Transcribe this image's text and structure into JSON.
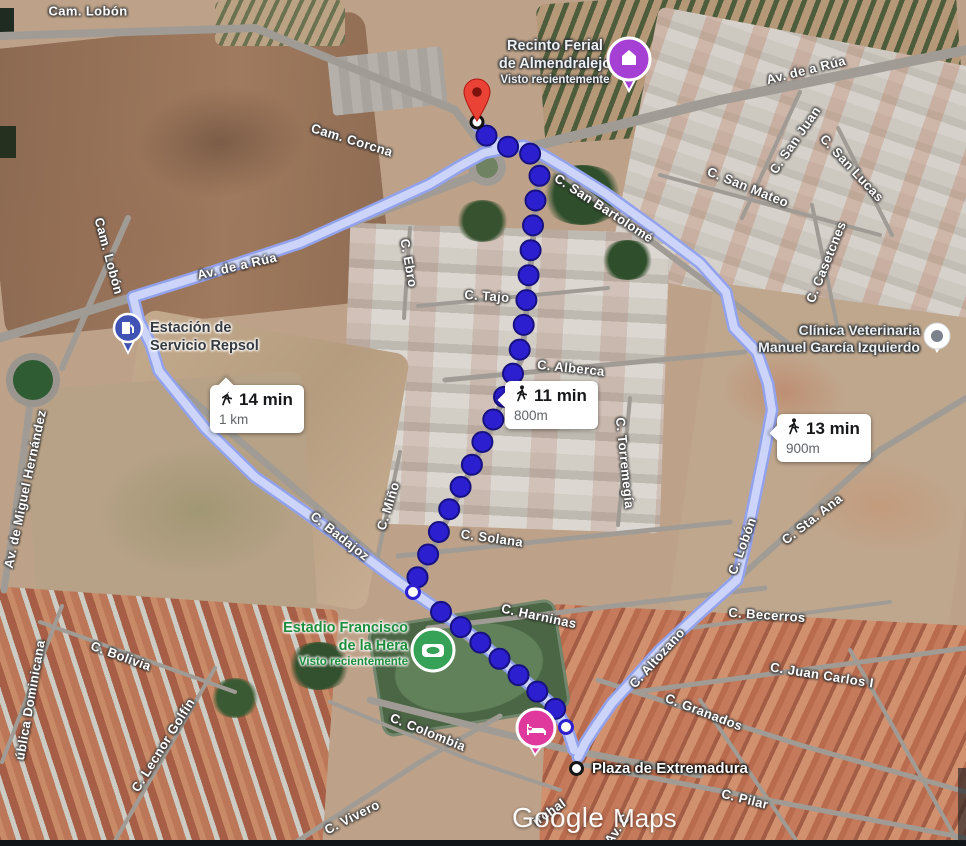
{
  "attribution": {
    "google": "Google",
    "maps": "Maps"
  },
  "badges": [
    {
      "id": "alt-left",
      "time": "14 min",
      "distance": "1 km"
    },
    {
      "id": "selected",
      "time": "11 min",
      "distance": "800m"
    },
    {
      "id": "alt-right",
      "time": "13 min",
      "distance": "900m"
    }
  ],
  "pois": {
    "recinto": {
      "line1": "Recinto Ferial",
      "line2": "de Almendralejo",
      "sub": "Visto recientemente"
    },
    "repsol": {
      "line1": "Estación de",
      "line2": "Servicio Repsol"
    },
    "clinica": {
      "line1": "Clínica Veterinaria",
      "line2": "Manuel García Izquierdo"
    },
    "estadio": {
      "line1": "Estadio Francisco",
      "line2": "de la Hera",
      "sub": "Visto recientemente"
    },
    "plaza": {
      "label": "Plaza de Extremadura"
    }
  },
  "streets": [
    {
      "t": "Cam. Lobón",
      "x": 88,
      "y": 11,
      "r": 0
    },
    {
      "t": "Cam. Lobón",
      "x": 109,
      "y": 256,
      "r": 75
    },
    {
      "t": "Cam. Corcna",
      "x": 352,
      "y": 140,
      "r": 17
    },
    {
      "t": "Av. de a Rúa",
      "x": 806,
      "y": 70,
      "r": -14
    },
    {
      "t": "Av. de a Rúa",
      "x": 237,
      "y": 266,
      "r": -13
    },
    {
      "t": "C. San Bartolomé",
      "x": 604,
      "y": 208,
      "r": 33
    },
    {
      "t": "C. San Juan",
      "x": 795,
      "y": 140,
      "r": -55
    },
    {
      "t": "C. San Mateo",
      "x": 748,
      "y": 187,
      "r": 22
    },
    {
      "t": "C. San Lucas",
      "x": 852,
      "y": 168,
      "r": 47
    },
    {
      "t": "C. Casetcnes",
      "x": 826,
      "y": 262,
      "r": -68
    },
    {
      "t": "C. Ebro",
      "x": 409,
      "y": 263,
      "r": 80
    },
    {
      "t": "C. Tajo",
      "x": 487,
      "y": 296,
      "r": 4
    },
    {
      "t": "C. Alberca",
      "x": 571,
      "y": 368,
      "r": 6
    },
    {
      "t": "C. Torremegía",
      "x": 625,
      "y": 463,
      "r": 84
    },
    {
      "t": "C. Miño",
      "x": 388,
      "y": 506,
      "r": -73
    },
    {
      "t": "C. Solana",
      "x": 492,
      "y": 538,
      "r": 8
    },
    {
      "t": "C. Harninas",
      "x": 539,
      "y": 616,
      "r": 12
    },
    {
      "t": "C. Badajoz",
      "x": 340,
      "y": 536,
      "r": 38
    },
    {
      "t": "C. Lobón",
      "x": 742,
      "y": 546,
      "r": -70
    },
    {
      "t": "C. Sta. Ana",
      "x": 812,
      "y": 519,
      "r": -38
    },
    {
      "t": "C. Becerros",
      "x": 767,
      "y": 615,
      "r": 4
    },
    {
      "t": "C. Altozano",
      "x": 657,
      "y": 658,
      "r": -48
    },
    {
      "t": "C. Juan Carlos I",
      "x": 822,
      "y": 675,
      "r": 9
    },
    {
      "t": "C. Granados",
      "x": 704,
      "y": 712,
      "r": 21
    },
    {
      "t": "C. Pilar",
      "x": 745,
      "y": 799,
      "r": 14
    },
    {
      "t": "C. Bolivia",
      "x": 121,
      "y": 656,
      "r": 20
    },
    {
      "t": "C. Lecnor Golfín",
      "x": 163,
      "y": 745,
      "r": -58
    },
    {
      "t": "ública Dominicana",
      "x": 30,
      "y": 700,
      "r": -80
    },
    {
      "t": "C. Vivero",
      "x": 352,
      "y": 817,
      "r": -27
    },
    {
      "t": "C. Colombia",
      "x": 428,
      "y": 732,
      "r": 22
    },
    {
      "t": "Av. de Miguel Hernández",
      "x": 25,
      "y": 489,
      "r": -78
    },
    {
      "t": "irchal",
      "x": 549,
      "y": 812,
      "r": -35
    },
    {
      "t": "Av. C",
      "x": 617,
      "y": 829,
      "r": -55
    }
  ],
  "routes": {
    "selected": {
      "mode": "walking",
      "time": "11 min",
      "distance": "800m",
      "dot_color": "#2c1fd0",
      "dot_border": "#17107f",
      "dot_spacing": 25,
      "dot_radius": 10,
      "start_point": [
        477,
        122
      ],
      "via_points": [
        [
          413,
          592
        ],
        [
          566,
          727
        ]
      ],
      "waypoints": [
        [
          477,
          124
        ],
        [
          491,
          141
        ],
        [
          509,
          147
        ],
        [
          524,
          147
        ],
        [
          535,
          159
        ],
        [
          540,
          173
        ],
        [
          536,
          196
        ],
        [
          531,
          245
        ],
        [
          527,
          295
        ],
        [
          522,
          340
        ],
        [
          516,
          365
        ],
        [
          508,
          388
        ],
        [
          498,
          410
        ],
        [
          487,
          432
        ],
        [
          468,
          473
        ],
        [
          452,
          503
        ],
        [
          438,
          534
        ],
        [
          424,
          563
        ],
        [
          414,
          585
        ],
        [
          413,
          592
        ],
        [
          436,
          608
        ],
        [
          475,
          638
        ],
        [
          515,
          672
        ],
        [
          548,
          701
        ],
        [
          558,
          712
        ],
        [
          565,
          724
        ],
        [
          566,
          740
        ],
        [
          571,
          753
        ]
      ]
    },
    "alt_color": "#ccd5f9",
    "alt_border": "#93a2ec",
    "alternatives": [
      {
        "time": "14 min",
        "distance": "1 km",
        "points": [
          [
            477,
            124
          ],
          [
            491,
            141
          ],
          [
            503,
            149
          ],
          [
            484,
            153
          ],
          [
            460,
            166
          ],
          [
            430,
            184
          ],
          [
            380,
            207
          ],
          [
            300,
            243
          ],
          [
            200,
            276
          ],
          [
            133,
            297
          ],
          [
            139,
            321
          ],
          [
            151,
            345
          ],
          [
            159,
            371
          ],
          [
            205,
            428
          ],
          [
            255,
            477
          ],
          [
            305,
            512
          ],
          [
            355,
            549
          ],
          [
            392,
            577
          ],
          [
            413,
            592
          ],
          [
            436,
            608
          ],
          [
            475,
            638
          ],
          [
            515,
            672
          ],
          [
            548,
            701
          ],
          [
            560,
            716
          ],
          [
            569,
            734
          ],
          [
            574,
            750
          ]
        ]
      },
      {
        "time": "13 min",
        "distance": "900m",
        "points": [
          [
            477,
            124
          ],
          [
            491,
            141
          ],
          [
            509,
            147
          ],
          [
            524,
            146
          ],
          [
            543,
            155
          ],
          [
            565,
            168
          ],
          [
            605,
            193
          ],
          [
            655,
            229
          ],
          [
            700,
            263
          ],
          [
            726,
            292
          ],
          [
            734,
            328
          ],
          [
            757,
            352
          ],
          [
            768,
            384
          ],
          [
            772,
            410
          ],
          [
            765,
            448
          ],
          [
            754,
            502
          ],
          [
            745,
            546
          ],
          [
            737,
            580
          ],
          [
            699,
            614
          ],
          [
            660,
            650
          ],
          [
            633,
            680
          ],
          [
            612,
            703
          ],
          [
            596,
            726
          ],
          [
            585,
            743
          ],
          [
            578,
            757
          ]
        ]
      }
    ]
  }
}
